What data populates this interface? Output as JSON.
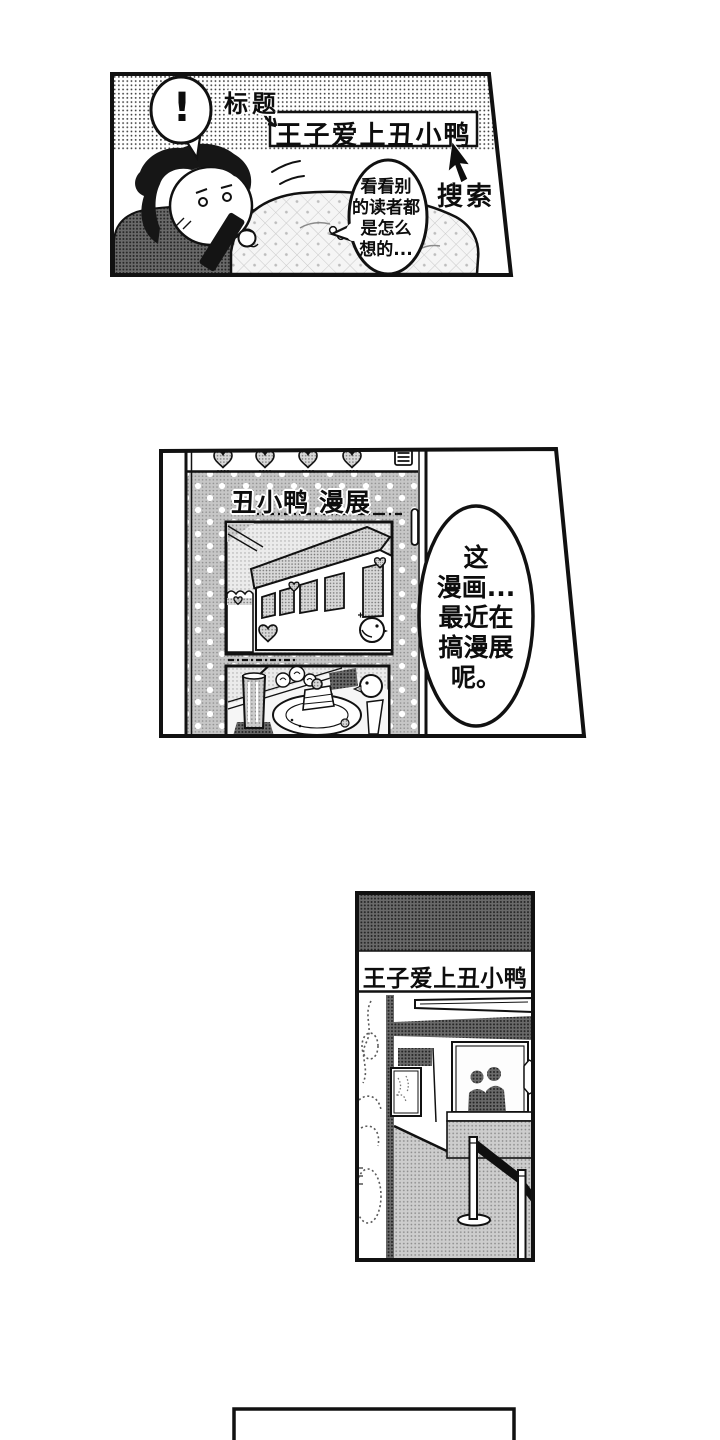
{
  "panel1": {
    "exclamation": "!",
    "title_label": "标题",
    "search_text": "王子爱上丑小鸭",
    "search_label": "搜索",
    "bubble": [
      "看看别",
      "的读者都",
      "是怎么",
      "想的..."
    ]
  },
  "panel2": {
    "screen_title": "丑小鸭 漫展",
    "bubble": [
      "这",
      "漫画...",
      "最近在",
      "搞漫展",
      "呢。"
    ]
  },
  "panel3": {
    "banner": "王子爱上丑小鸭"
  },
  "icons": {
    "menu_icon": "hamburger-three-lines",
    "strawberry_icon": "dotted-heart-strawberry",
    "cursor_icon": "black-mouse-pointer",
    "scrollbar_thumb": "white-pill",
    "chick_icon": "small-chick",
    "heart_icon": "halftone-heart"
  },
  "colors": {
    "ink": "#111111",
    "paper": "#ffffff",
    "halftone_dark": "#5f5f5f",
    "halftone_light": "#cdcdcd"
  }
}
